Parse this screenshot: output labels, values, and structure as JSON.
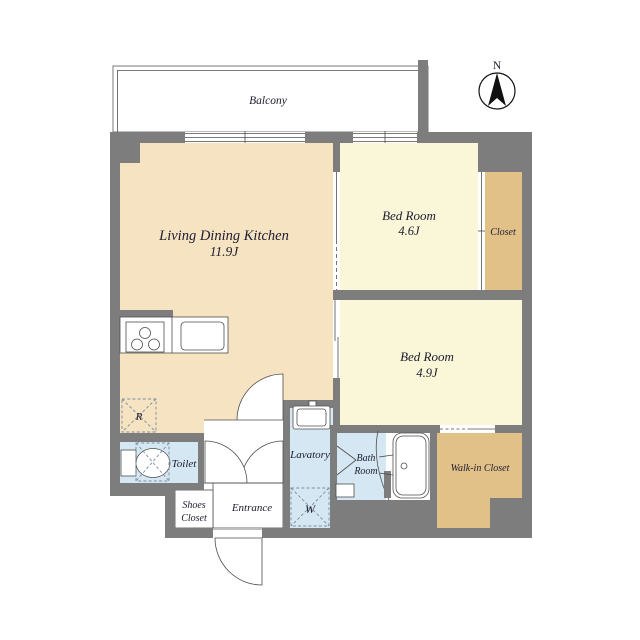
{
  "compass": {
    "north_label": "N"
  },
  "balcony": {
    "label": "Balcony"
  },
  "ldk": {
    "name": "Living Dining Kitchen",
    "size": "11.9J"
  },
  "bedroom_a": {
    "name": "Bed Room",
    "size": "4.6J"
  },
  "bedroom_b": {
    "name": "Bed Room",
    "size": "4.9J"
  },
  "closet": {
    "label": "Closet"
  },
  "walk_in_closet": {
    "label": "Walk-in Closet"
  },
  "toilet": {
    "label": "Toilet"
  },
  "lavatory": {
    "label": "Lavatory"
  },
  "bath_room": {
    "line1": "Bath",
    "line2": "Room"
  },
  "entrance": {
    "label": "Entrance"
  },
  "shoes_closet": {
    "line1": "Shoes",
    "line2": "Closet"
  },
  "markers": {
    "refrigerator": "R",
    "washer": "W"
  },
  "colors": {
    "wall": "#7d7d7d",
    "ldk_floor": "#f6e3c2",
    "bedroom_floor": "#faf6d8",
    "closet_floor": "#e2c189",
    "wet_floor": "#d5e7f2",
    "line": "#4f4f4f",
    "text": "#1c1c2e"
  }
}
